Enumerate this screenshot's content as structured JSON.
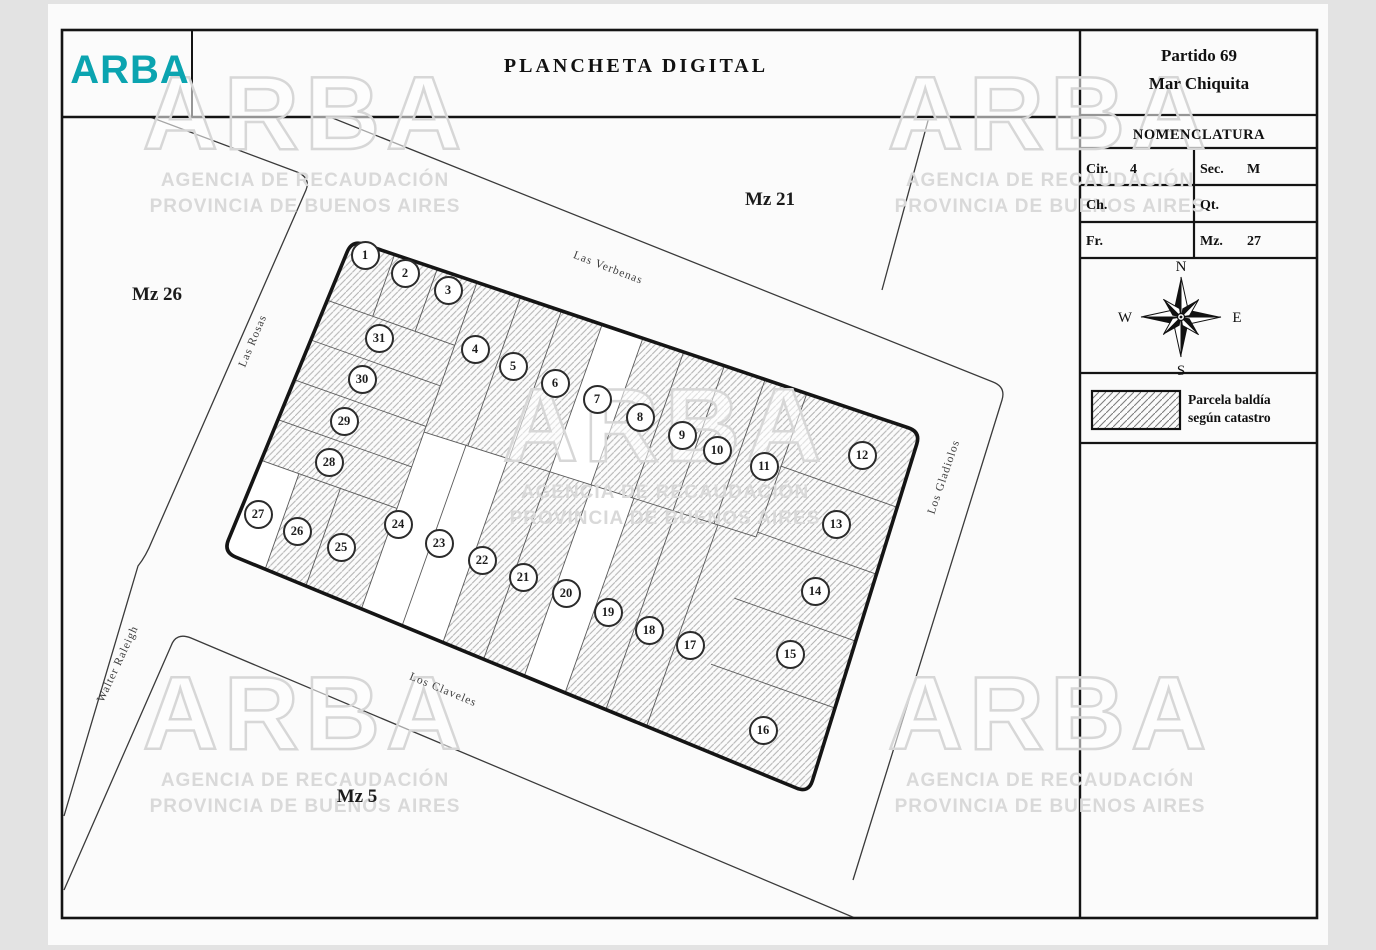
{
  "header": {
    "logo": "ARBA",
    "title": "PLANCHETA DIGITAL"
  },
  "panel": {
    "partido_line1": "Partido 69",
    "partido_line2": "Mar Chiquita",
    "nomenclatura_title": "NOMENCLATURA",
    "fields": [
      {
        "label": "Cir.",
        "value": "4"
      },
      {
        "label": "Sec.",
        "value": "M"
      },
      {
        "label": "Ch.",
        "value": ""
      },
      {
        "label": "Qt.",
        "value": ""
      },
      {
        "label": "Fr.",
        "value": ""
      },
      {
        "label": "Mz.",
        "value": "27"
      }
    ],
    "compass": {
      "n": "N",
      "s": "S",
      "e": "E",
      "w": "W"
    },
    "legend": {
      "line1": "Parcela baldía",
      "line2": "según catastro"
    }
  },
  "map": {
    "blocks": [
      {
        "label": "Mz 21"
      },
      {
        "label": "Mz 26"
      },
      {
        "label": "Mz 5"
      }
    ],
    "streets": [
      {
        "name": "Las Verbenas"
      },
      {
        "name": "Las Rosas"
      },
      {
        "name": "Los Gladiolos"
      },
      {
        "name": "Los Claveles"
      },
      {
        "name": "Walter Raleigh"
      }
    ],
    "parcels": [
      {
        "number": 1,
        "baldia": true,
        "x": 365,
        "y": 255
      },
      {
        "number": 2,
        "baldia": true,
        "x": 405,
        "y": 273
      },
      {
        "number": 3,
        "baldia": true,
        "x": 448,
        "y": 290
      },
      {
        "number": 4,
        "baldia": true,
        "x": 475,
        "y": 349
      },
      {
        "number": 5,
        "baldia": true,
        "x": 513,
        "y": 366
      },
      {
        "number": 6,
        "baldia": true,
        "x": 555,
        "y": 383
      },
      {
        "number": 7,
        "baldia": false,
        "x": 597,
        "y": 399
      },
      {
        "number": 8,
        "baldia": true,
        "x": 640,
        "y": 417
      },
      {
        "number": 9,
        "baldia": true,
        "x": 682,
        "y": 435
      },
      {
        "number": 10,
        "baldia": true,
        "x": 717,
        "y": 450
      },
      {
        "number": 11,
        "baldia": true,
        "x": 764,
        "y": 466
      },
      {
        "number": 12,
        "baldia": true,
        "x": 862,
        "y": 455
      },
      {
        "number": 13,
        "baldia": true,
        "x": 836,
        "y": 524
      },
      {
        "number": 14,
        "baldia": true,
        "x": 815,
        "y": 591
      },
      {
        "number": 15,
        "baldia": true,
        "x": 790,
        "y": 654
      },
      {
        "number": 16,
        "baldia": true,
        "x": 763,
        "y": 730
      },
      {
        "number": 17,
        "baldia": true,
        "x": 690,
        "y": 645
      },
      {
        "number": 18,
        "baldia": true,
        "x": 649,
        "y": 630
      },
      {
        "number": 19,
        "baldia": true,
        "x": 608,
        "y": 612
      },
      {
        "number": 20,
        "baldia": false,
        "x": 566,
        "y": 593
      },
      {
        "number": 21,
        "baldia": true,
        "x": 523,
        "y": 577
      },
      {
        "number": 22,
        "baldia": true,
        "x": 482,
        "y": 560
      },
      {
        "number": 23,
        "baldia": false,
        "x": 439,
        "y": 543
      },
      {
        "number": 24,
        "baldia": false,
        "x": 398,
        "y": 524
      },
      {
        "number": 25,
        "baldia": true,
        "x": 341,
        "y": 547
      },
      {
        "number": 26,
        "baldia": true,
        "x": 297,
        "y": 531
      },
      {
        "number": 27,
        "baldia": false,
        "x": 258,
        "y": 514
      },
      {
        "number": 28,
        "baldia": true,
        "x": 329,
        "y": 462
      },
      {
        "number": 29,
        "baldia": true,
        "x": 344,
        "y": 421
      },
      {
        "number": 30,
        "baldia": true,
        "x": 362,
        "y": 379
      },
      {
        "number": 31,
        "baldia": true,
        "x": 379,
        "y": 338
      }
    ]
  },
  "watermark": {
    "brand": "ARBA",
    "line1": "AGENCIA DE RECAUDACIÓN",
    "line2": "PROVINCIA DE BUENOS AIRES"
  }
}
